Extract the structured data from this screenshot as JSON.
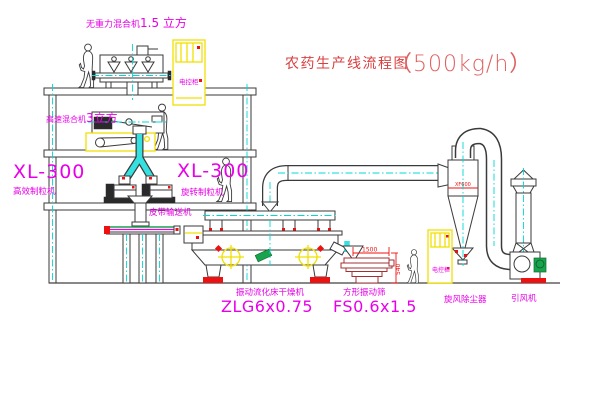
{
  "title": {
    "main": "农药生产线流程图",
    "capacity": "（500kg/h）"
  },
  "equipment": {
    "no_gravity_mixer": {
      "name": "无重力混合机",
      "size": "1.5 立方"
    },
    "high_speed_mixer": {
      "name": "高速混合机",
      "size": "3立方"
    },
    "granulator_left": {
      "model": "XL-300",
      "name": "高效制粒机"
    },
    "granulator_right": {
      "model": "XL-300",
      "name": "旋转制粒机"
    },
    "belt_conveyor": {
      "name": "皮带输送机"
    },
    "fluid_bed_dryer": {
      "name": "振动流化床干燥机",
      "model": "ZLG6x0.75"
    },
    "vibrating_sieve": {
      "name": "方形振动筛",
      "model": "FS0.6x1.5",
      "dim_width": "1500",
      "dim_height": "540"
    },
    "cyclone": {
      "name": "旋风除尘器",
      "tag": "XF600"
    },
    "fan": {
      "name": "引风机"
    },
    "control_cabinet": {
      "name": "电控柜"
    }
  },
  "colors": {
    "label_magenta": "#e800e8",
    "title_red": "#d84040",
    "centerline_cyan": "#00d8d8",
    "accent_yellow": "#f0e000",
    "accent_red": "#ee1111",
    "accent_green": "#18a44c",
    "line_dark": "#3a3a3a",
    "sieve_dark_red": "#a23030"
  }
}
